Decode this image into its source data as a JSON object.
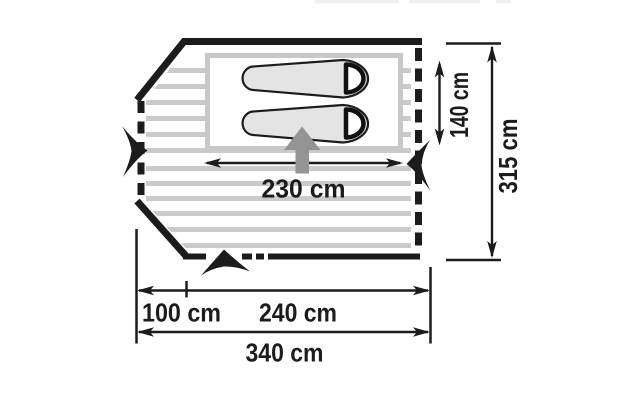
{
  "diagram": {
    "type": "tent-floorplan-top-view",
    "dimensions": {
      "inner_width_label": "230 cm",
      "inner_depth_label": "140 cm",
      "total_depth_label": "315 cm",
      "porch_width_label": "100 cm",
      "main_width_label": "240 cm",
      "total_width_label": "340 cm"
    },
    "measurements_cm": {
      "inner_width": 230,
      "inner_depth": 140,
      "total_depth": 315,
      "porch_width": 100,
      "main_width": 240,
      "total_width": 340
    },
    "icons": {
      "sleeping_bags": "two mummy sleeping bags in inner tent",
      "entrance_arrow": "gray up-arrow marking tent entrance",
      "entrance_markers": "black chevron markers on left, right and bottom walls"
    },
    "colors": {
      "line": "#1c1c1c",
      "floor_stripe": "#cbcbcb",
      "inner_border": "#c8c8c8",
      "bag_fill": "#e4e4e4",
      "bag_outline": "#1c1c1c",
      "hood_stroke": "#111111",
      "entrance_arrow": "#949494",
      "artifact": "#f0f0f0"
    }
  }
}
